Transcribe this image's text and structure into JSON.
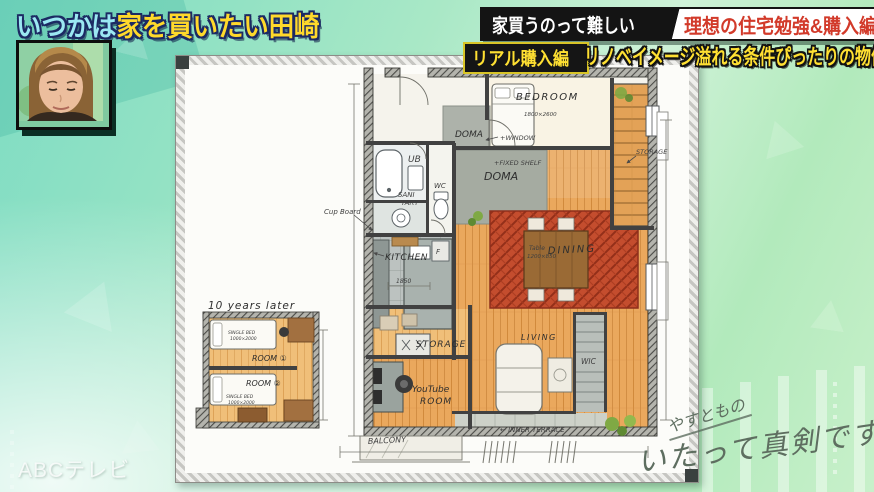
{
  "header": {
    "title": {
      "part1": "いつかは",
      "part2": "家を買いたい田崎"
    },
    "banner1": {
      "left": "家買うのって難しい",
      "right": "理想の住宅勉強&購入編"
    },
    "banner2": {
      "left": "リアル購入編",
      "right": "リノベイメージ溢れる条件ぴったりの物件"
    }
  },
  "floorplan": {
    "labels": {
      "bedroom": "BEDROOM",
      "bedroom_size": "1800×2600",
      "doma_upper": "DOMA",
      "doma_lower": "DOMA",
      "ub": "UB",
      "wc": "WC",
      "sanitary1": "SANI",
      "sanitary2": "TARY",
      "cup_board": "Cup Board",
      "kitchen": "KITCHEN",
      "kitchen_dim": "1850",
      "fridge": "F",
      "window_note": "+WINDOW",
      "fixed_shelf_note": "+FIXED SHELF",
      "storage_note": "STORAGE",
      "dining": "DINING",
      "table1": "Table",
      "table2": "1200×850",
      "living": "LIVING",
      "wic": "WIC",
      "storage_room": "STORAGE",
      "youtube1": "YouTube",
      "youtube2": "ROOM",
      "balcony": "BALCONY",
      "inner_terrace": "← INNER TERRACE"
    },
    "mini": {
      "title": "10 years later",
      "room1": "ROOM ①",
      "room2": "ROOM ②",
      "single_bed": "SINGLE BED",
      "bed_size": "1000×2000"
    }
  },
  "watermark": "ABCテレビ",
  "logo": {
    "line1": "やすともの",
    "line2": "いたって真剣です"
  },
  "colors": {
    "accent_yellow": "#ffd92b",
    "accent_cyan": "#9be8f2",
    "banner_red": "#d23a2a",
    "bg_green": "#9fe5c3",
    "wood": "#eba95e",
    "rug_red": "#c14a2d"
  }
}
